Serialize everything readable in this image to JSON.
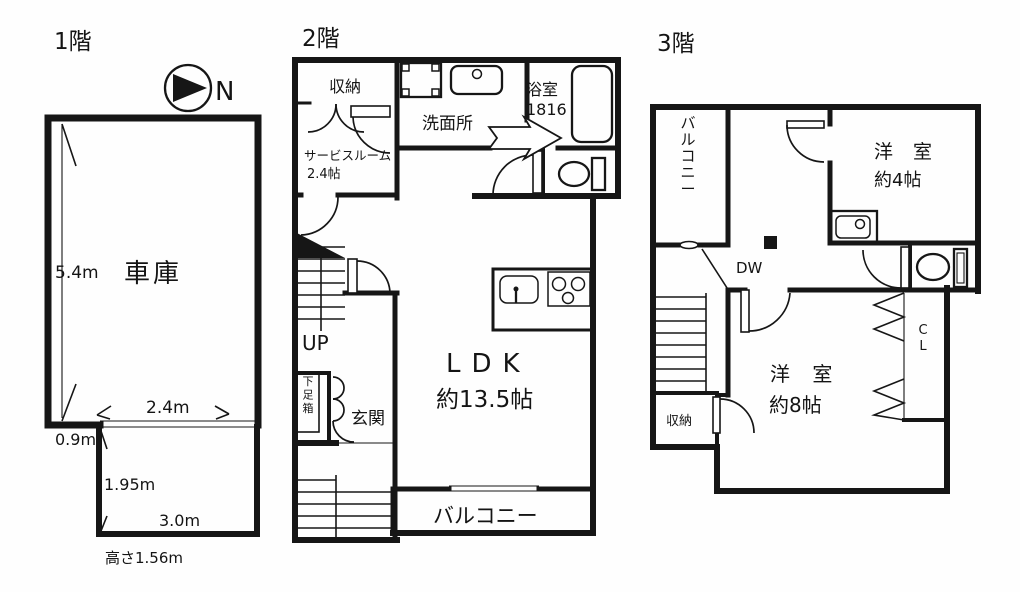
{
  "floor1": {
    "label": "1階",
    "north_label": "N",
    "garage": "車庫",
    "dim_left": "5.4m",
    "dim_bottom": "2.4m",
    "dim_offset": "0.9m",
    "storage_dim_left": "1.95m",
    "storage_dim_bottom": "3.0m",
    "height_note": "高さ1.56m"
  },
  "floor2": {
    "label": "2階",
    "closet": "収納",
    "service_room": "サービスルーム",
    "service_room_size": "2.4帖",
    "washroom": "洗面所",
    "bath": "浴室",
    "bath_size": "1816",
    "stairs_up": "UP",
    "shoe_cabinet": "下足箱",
    "entrance": "玄関",
    "ldk": "LDK",
    "ldk_size": "約13.5帖",
    "balcony": "バルコニー"
  },
  "floor3": {
    "label": "3階",
    "balcony": "バルコニー",
    "room4": "洋 室",
    "room4_size": "約4帖",
    "dumbwaiter": "DW",
    "closet_label": "CL",
    "storage": "収納",
    "room8": "洋 室",
    "room8_size": "約8帖"
  }
}
